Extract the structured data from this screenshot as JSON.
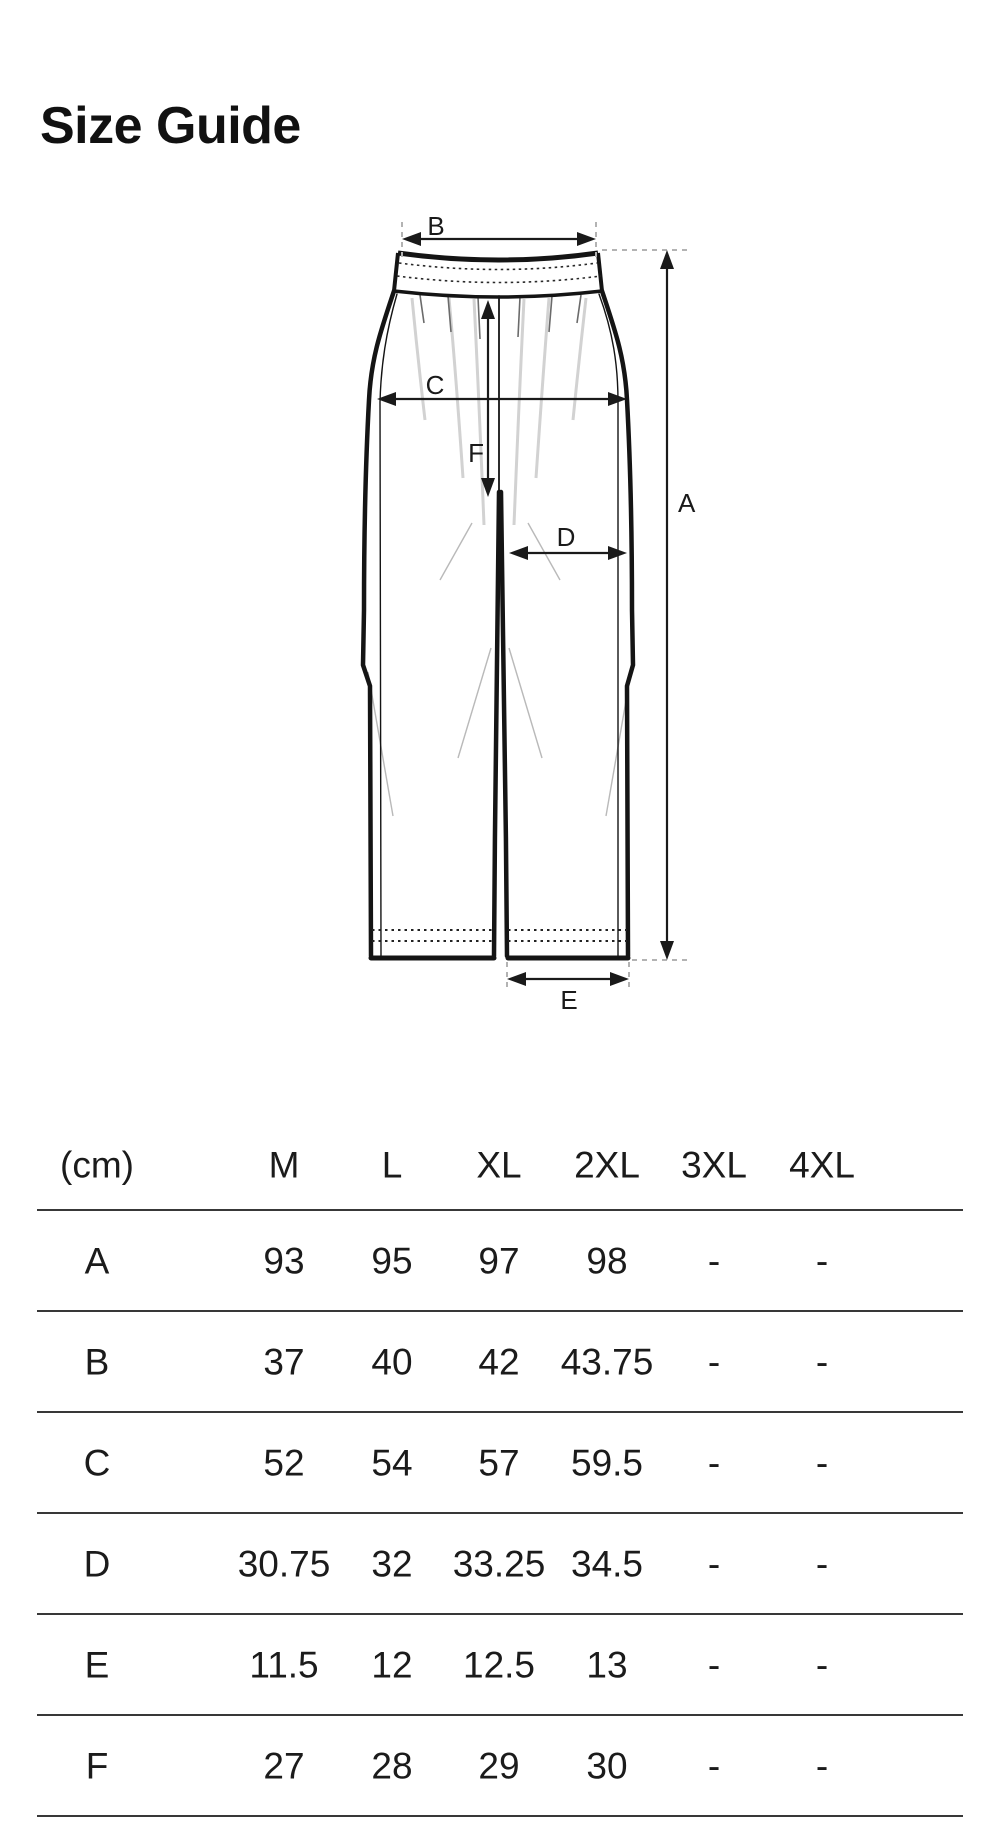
{
  "page": {
    "title": "Size Guide"
  },
  "diagram": {
    "name": "pants-measurement-diagram",
    "labels": {
      "a": "A",
      "b": "B",
      "c": "C",
      "d": "D",
      "e": "E",
      "f": "F"
    }
  },
  "table": {
    "unit_header": "(cm)",
    "columns": [
      "M",
      "L",
      "XL",
      "2XL",
      "3XL",
      "4XL"
    ],
    "rows": [
      {
        "label": "A",
        "values": [
          "93",
          "95",
          "97",
          "98",
          "-",
          "-"
        ]
      },
      {
        "label": "B",
        "values": [
          "37",
          "40",
          "42",
          "43.75",
          "-",
          "-"
        ]
      },
      {
        "label": "C",
        "values": [
          "52",
          "54",
          "57",
          "59.5",
          "-",
          "-"
        ]
      },
      {
        "label": "D",
        "values": [
          "30.75",
          "32",
          "33.25",
          "34.5",
          "-",
          "-"
        ]
      },
      {
        "label": "E",
        "values": [
          "11.5",
          "12",
          "12.5",
          "13",
          "-",
          "-"
        ]
      },
      {
        "label": "F",
        "values": [
          "27",
          "28",
          "29",
          "30",
          "-",
          "-"
        ]
      }
    ],
    "colors": {
      "divider": "#383838",
      "text": "#1b1b1b"
    }
  },
  "colors": {
    "outline": "#141414",
    "guide_dash": "#b3b3b3",
    "crease": "#d2d2d2"
  }
}
